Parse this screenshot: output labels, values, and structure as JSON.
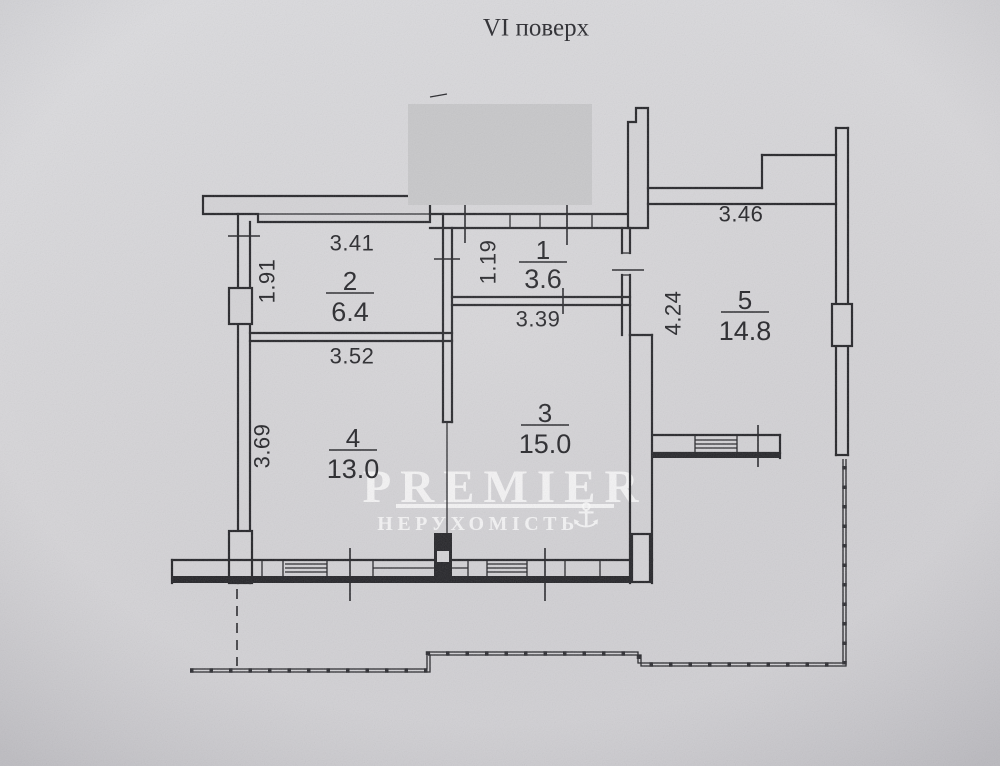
{
  "page": {
    "title": "VI поверх"
  },
  "plan": {
    "rooms": [
      {
        "number": "1",
        "area": "3.6",
        "dims": [
          "1.19"
        ]
      },
      {
        "number": "2",
        "area": "6.4",
        "dims": [
          "3.41",
          "1.91"
        ]
      },
      {
        "number": "3",
        "area": "15.0",
        "dims": [
          "3.39",
          "4.24"
        ]
      },
      {
        "number": "4",
        "area": "13.0",
        "dims": [
          "3.52",
          "3.69"
        ]
      },
      {
        "number": "5",
        "area": "14.8",
        "dims": [
          "3.46"
        ]
      }
    ],
    "watermark": {
      "brand": "PREMIER",
      "subtitle": "НЕРУХОМІСТЬ",
      "anchor_icon": "⚓"
    },
    "colors": {
      "paper": "#d5d4d7",
      "ink": "#232327",
      "redaction_box": "#c8c8ca",
      "watermark": "#ffffff"
    }
  }
}
